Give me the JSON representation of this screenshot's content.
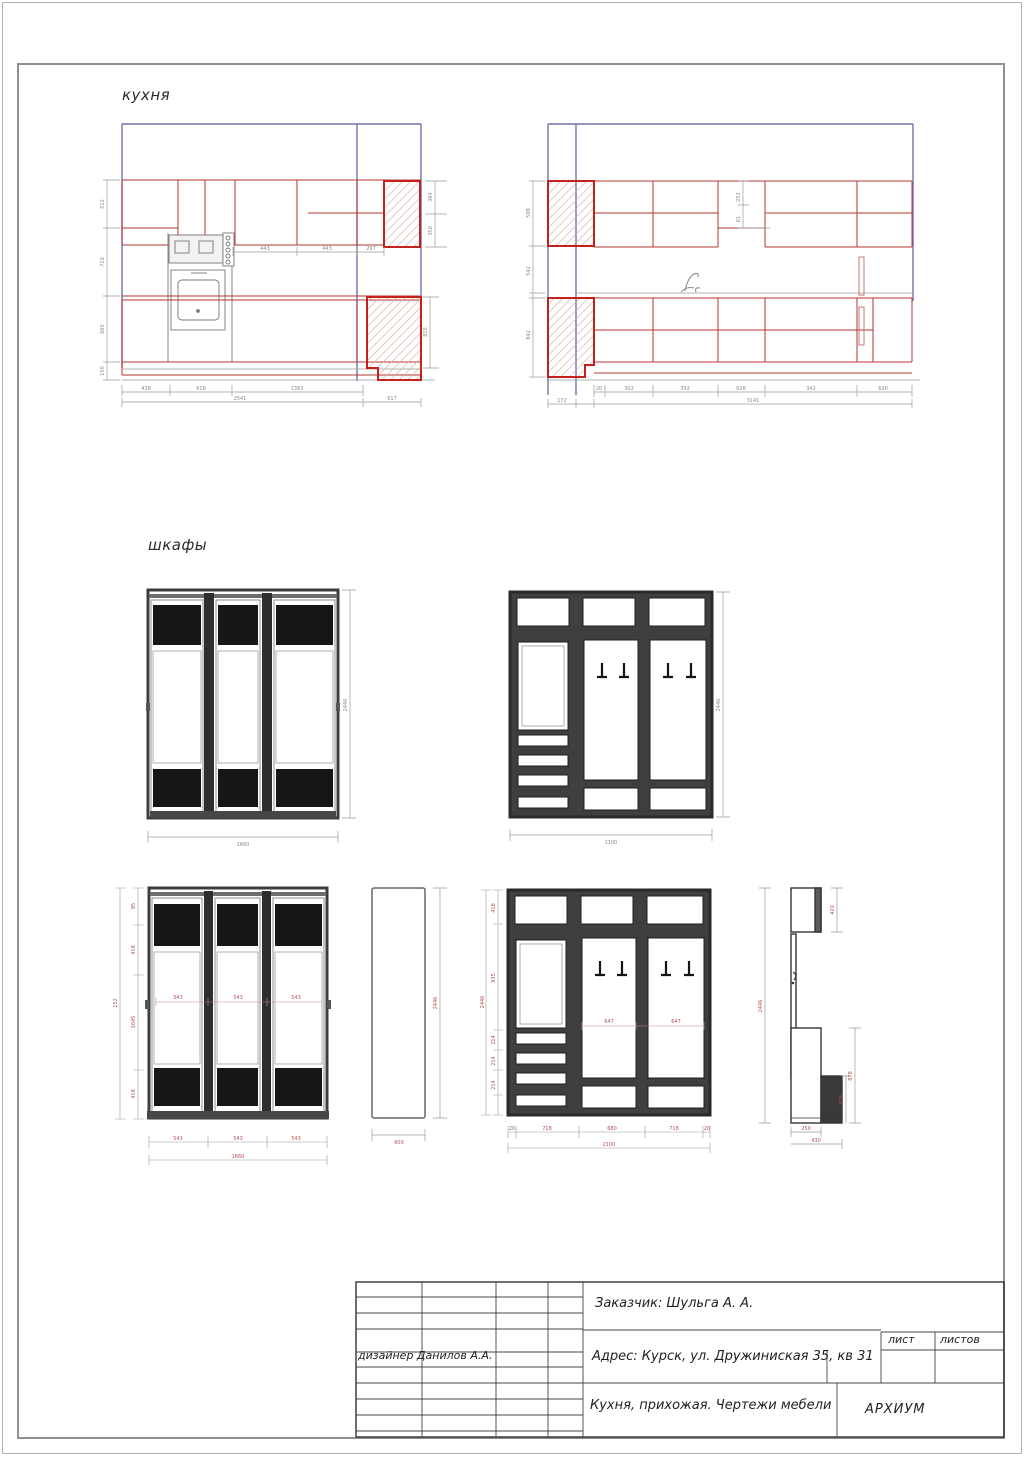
{
  "labels": {
    "kitchen": "кухня",
    "wardrobes": "шкафы"
  },
  "title_block": {
    "customer": "Заказчик: Шульга А. А.",
    "designer": "дизайнер Данилов А.А.",
    "address": "Адрес: Курск, ул. Дружиниская 35, кв 31",
    "subject": "Кухня, прихожая. Чертежи мебели",
    "studio": "АРХИУМ",
    "sheet_label": "лист",
    "sheets_label": "листов"
  },
  "colors": {
    "cabinet_red": "#b63430",
    "hatch_border_red": "#c4201d",
    "wall_blue": "#7173ae",
    "dim_gray": "#9a9a9a",
    "wardrobe_dark": "#161616"
  },
  "dims": {
    "kitchen_left": {
      "mid": [
        "443",
        "443",
        "297"
      ],
      "left": [
        "512",
        "710",
        "665",
        "150"
      ],
      "right_top": [
        "364",
        "350"
      ],
      "right_bottom": [
        "815"
      ],
      "bottom1": [
        "438",
        "618",
        "1383"
      ],
      "bottom2": [
        "2541",
        "617"
      ]
    },
    "kitchen_right": {
      "hood": [
        "252",
        "61"
      ],
      "left": [
        "598",
        "542",
        "842"
      ],
      "bottom1": [
        "20",
        "302",
        "352",
        "628",
        "342",
        "620"
      ],
      "bottom2": [
        "172",
        "3141"
      ]
    },
    "wardrobe_top": {
      "height": "2446",
      "width": "1660"
    },
    "hallway_top": {
      "height": "2446",
      "width": "2100"
    },
    "wardrobe_dim": {
      "doors": [
        "543",
        "543",
        "543"
      ],
      "left": [
        "95",
        "418",
        "1045",
        "418",
        "152"
      ],
      "height": "2446",
      "bottom": [
        "543",
        "543",
        "543"
      ],
      "total": "1660"
    },
    "side_panel": {
      "height": "2446",
      "width": "600"
    },
    "hallway_dim": {
      "panels": [
        "647",
        "647"
      ],
      "left": [
        "418",
        "935",
        "214",
        "214",
        "214"
      ],
      "height": "2446",
      "bottom": [
        "20",
        "718",
        "680",
        "718",
        "20"
      ],
      "total": "2100"
    },
    "profile": {
      "height": "2446",
      "top": "420",
      "lower": "878",
      "bench": "478",
      "b1": "250",
      "b2": "430"
    }
  }
}
